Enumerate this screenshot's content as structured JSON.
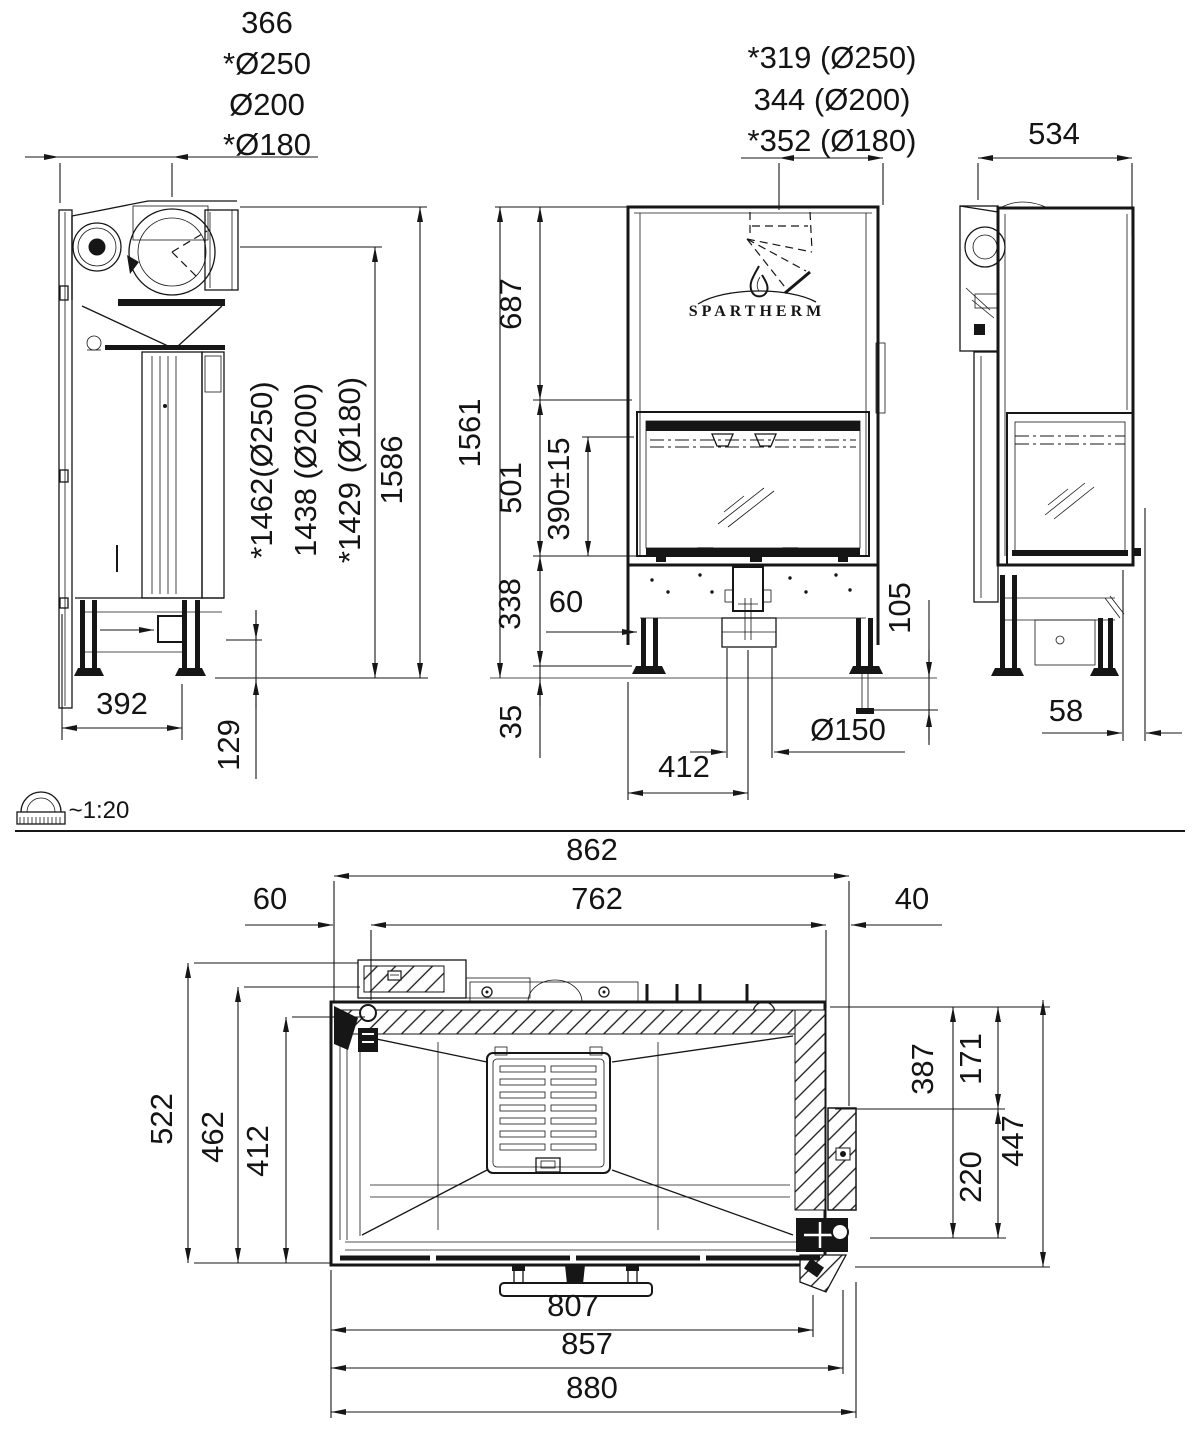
{
  "drawing": {
    "brand_logo": "SPARTHERM",
    "scale_note": "~1:20",
    "side_left_view": {
      "flue_offset_stack": [
        "366",
        "*Ø250",
        "Ø200",
        "*Ø180"
      ],
      "height_overall": "1586",
      "flue_height_stack": [
        "*1462(Ø250)",
        "1438 (Ø200)",
        "*1429 (Ø180)"
      ],
      "depth_feet": "392",
      "base_height": "129"
    },
    "front_view": {
      "flue_offset_stack": [
        "*319 (Ø250)",
        "344 (Ø200)",
        "*352 (Ø180)"
      ],
      "height_total": "1561",
      "height_upper": "687",
      "height_door": "501",
      "height_glass": "390±15",
      "height_base": "338",
      "floor_clearance": "35",
      "leg_offset": "60",
      "base_width": "412",
      "flue_diameter": "Ø150",
      "foot_adjust": "105"
    },
    "side_right_view": {
      "depth": "534",
      "front_offset": "58"
    },
    "top_view": {
      "width_outer": "862",
      "width_inner": "762",
      "offset_left": "60",
      "offset_right": "40",
      "depth_total": "522",
      "depth_body": "462",
      "depth_inner": "412",
      "depth_right_a": "387",
      "depth_right_b": "171",
      "depth_right_c": "220",
      "depth_right_total": "447",
      "width_bottom_a": "807",
      "width_bottom_b": "857",
      "width_bottom_c": "880"
    }
  }
}
